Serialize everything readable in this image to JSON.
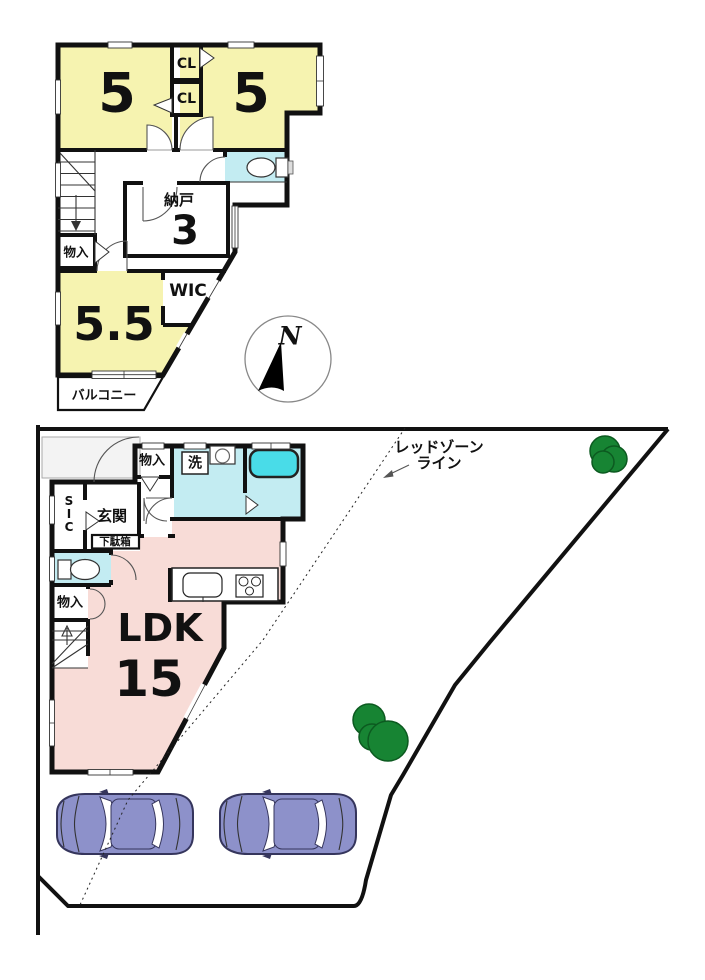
{
  "colors": {
    "wall": "#111111",
    "room_yellow": "#F6F3B0",
    "room_cyan": "#C3ECF2",
    "bathtub_cyan": "#49DCE8",
    "room_pink": "#F8DCD7",
    "car_body": "#8D91CA",
    "car_outline": "#35355C",
    "tree_green": "#178433",
    "tree_outline": "#0C5A20",
    "porch_gray": "#F3F3F3"
  },
  "floor2": {
    "room5_left": "5",
    "room5_right": "5",
    "closet_upper": "CL",
    "closet_lower": "CL",
    "storage_name": "納戸",
    "storage_size": "3",
    "closet_small": "物入",
    "wic": "WIC",
    "room_55": "5.5",
    "balcony": "バルコニー",
    "compass_north": "N"
  },
  "floor1": {
    "closet_upper": "物入",
    "laundry": "洗",
    "sic_s": "S",
    "sic_i": "I",
    "sic_c": "C",
    "entrance": "玄関",
    "shoe_cabinet": "下駄箱",
    "closet_lower": "物入",
    "ldk_label": "LDK",
    "ldk_size": "15",
    "redzone_line1": "レッドゾーン",
    "redzone_line2": "ライン"
  }
}
